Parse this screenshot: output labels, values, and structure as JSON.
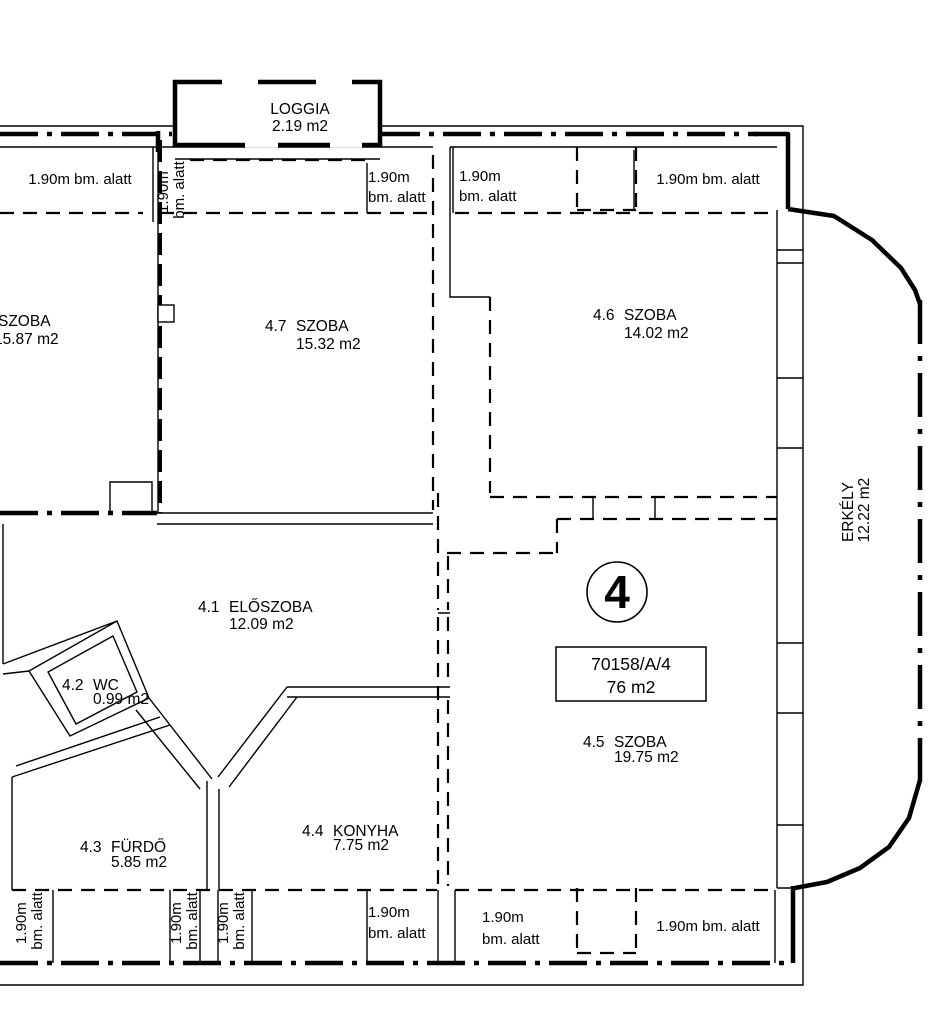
{
  "plan": {
    "unit_badge": "4",
    "unit_box": {
      "lot": "70158/A/4",
      "area": "76 m2"
    },
    "height_note": {
      "full": "1.90m bm. alatt",
      "l1": "1.90m",
      "l2": "bm. alatt"
    },
    "rooms": {
      "left_partial": {
        "name": "SZOBA",
        "area": "15.87 m2"
      },
      "r41": {
        "id": "4.1",
        "name": "ELŐSZOBA",
        "area": "12.09 m2"
      },
      "r42": {
        "id": "4.2",
        "name": "WC",
        "area": "0.99 m2"
      },
      "r43": {
        "id": "4.3",
        "name": "FÜRDŐ",
        "area": "5.85 m2"
      },
      "r44": {
        "id": "4.4",
        "name": "KONYHA",
        "area": "7.75 m2"
      },
      "r45": {
        "id": "4.5",
        "name": "SZOBA",
        "area": "19.75 m2"
      },
      "r46": {
        "id": "4.6",
        "name": "SZOBA",
        "area": "14.02 m2"
      },
      "r47": {
        "id": "4.7",
        "name": "SZOBA",
        "area": "15.32 m2"
      }
    },
    "outdoor": {
      "loggia": {
        "name": "LOGGIA",
        "area": "2.19 m2"
      },
      "erkely": {
        "name": "ERKÉLY",
        "area": "12.22 m2"
      }
    },
    "colors": {
      "ink": "#000000",
      "paper": "#ffffff"
    }
  }
}
